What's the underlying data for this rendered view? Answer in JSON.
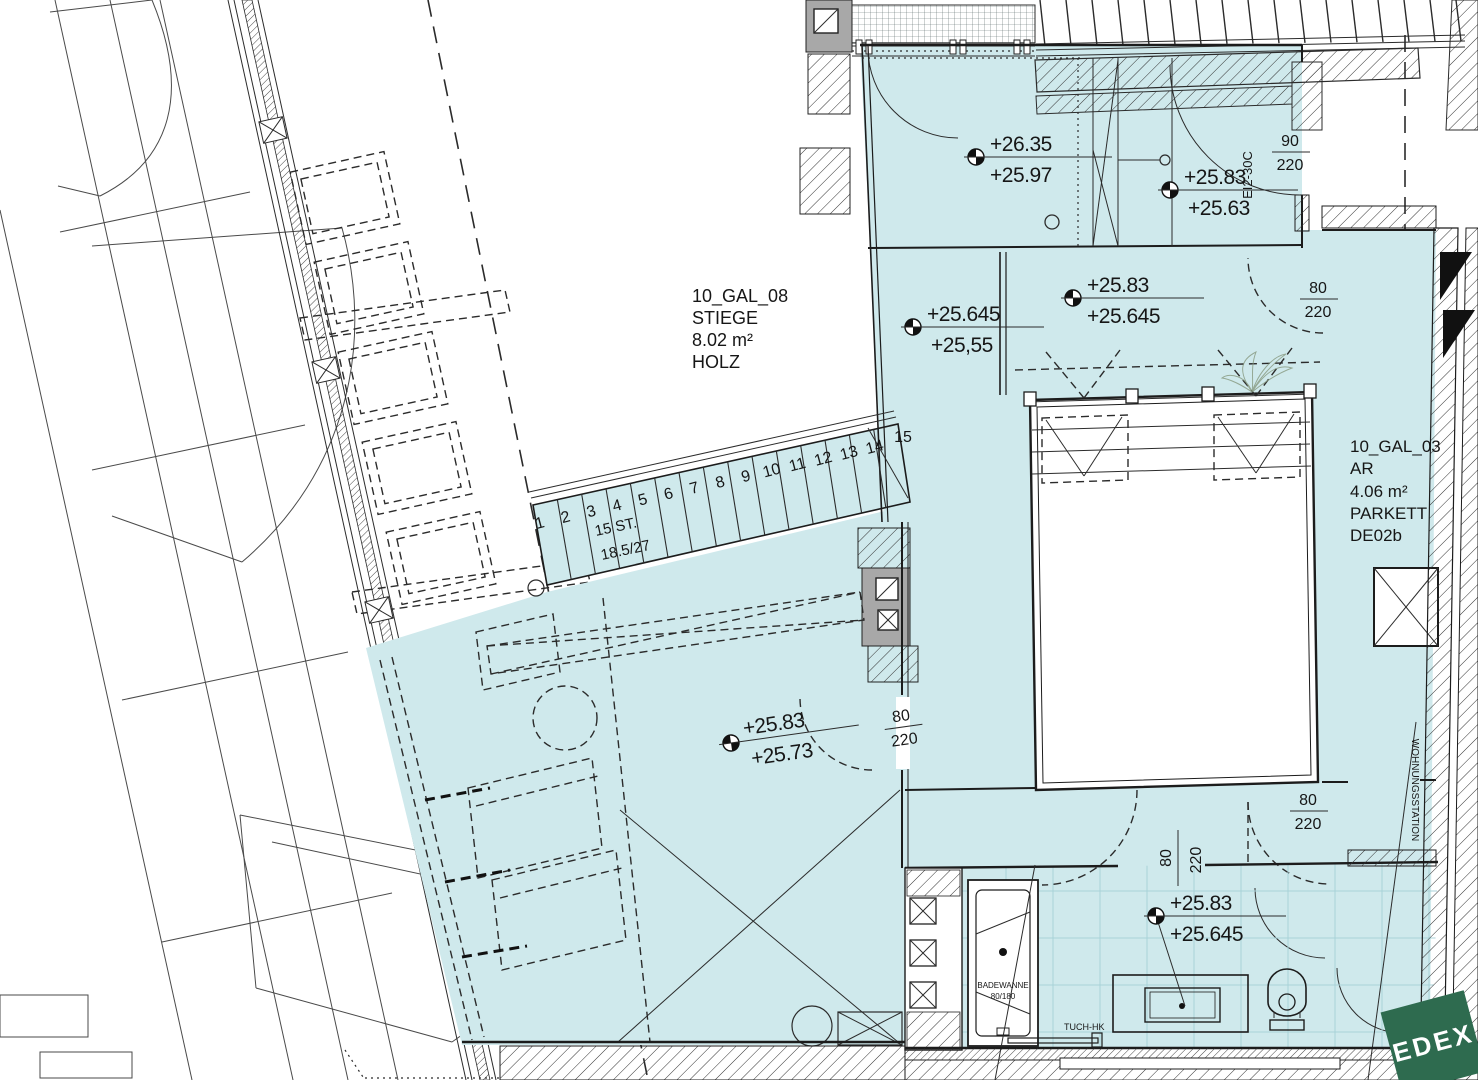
{
  "plan": {
    "rooms": {
      "stiege": {
        "code": "10_GAL_08",
        "name": "STIEGE",
        "area": "8.02  m²",
        "finish": "HOLZ"
      },
      "ar": {
        "code": "10_GAL_03",
        "name": "AR",
        "area": "4.06  m²",
        "finish": "PARKETT",
        "detail": "DE02b"
      }
    },
    "levels": {
      "vestibule": {
        "upper": "+26.35",
        "lower": "+25.97"
      },
      "vestibule_door": {
        "upper": "+25.83",
        "lower": "+25.63"
      },
      "gallery_west": {
        "upper": "+25.645",
        "lower": "+25,55"
      },
      "gallery_east": {
        "upper": "+25.83",
        "lower": "+25.645"
      },
      "room": {
        "upper": "+25.83",
        "lower": "+25.73"
      },
      "bath": {
        "upper": "+25.83",
        "lower": "+25.645"
      }
    },
    "doors": {
      "entry": {
        "width": "90",
        "height": "220",
        "rating": "EI2-30C"
      },
      "ar": {
        "width": "80",
        "height": "220"
      },
      "room": {
        "width": "80",
        "height": "220"
      },
      "corridor": {
        "width": "80",
        "height": "220"
      },
      "bath": {
        "width": "80",
        "height": "220"
      }
    },
    "stair": {
      "steps": [
        "1",
        "2",
        "3",
        "4",
        "5",
        "6",
        "7",
        "8",
        "9",
        "10",
        "11",
        "12",
        "13",
        "14"
      ],
      "last_step": "15",
      "count": "15 ST.",
      "ratio": "18.5/27"
    },
    "labels": {
      "wohnungsstation": "WOHNUNGSSTATION",
      "bathtub": "BADEWANNE",
      "bathtub_size": "80/180",
      "towel": "TUCH-HK"
    },
    "logo": {
      "text": "EDEX"
    }
  },
  "colors": {
    "room_fill": "#cfe9ec",
    "tile_line": "#a9d2d8",
    "wall_gray": "#a8a8a8",
    "logo_green": "#2e6b4f",
    "line": "#1c1c1c"
  }
}
